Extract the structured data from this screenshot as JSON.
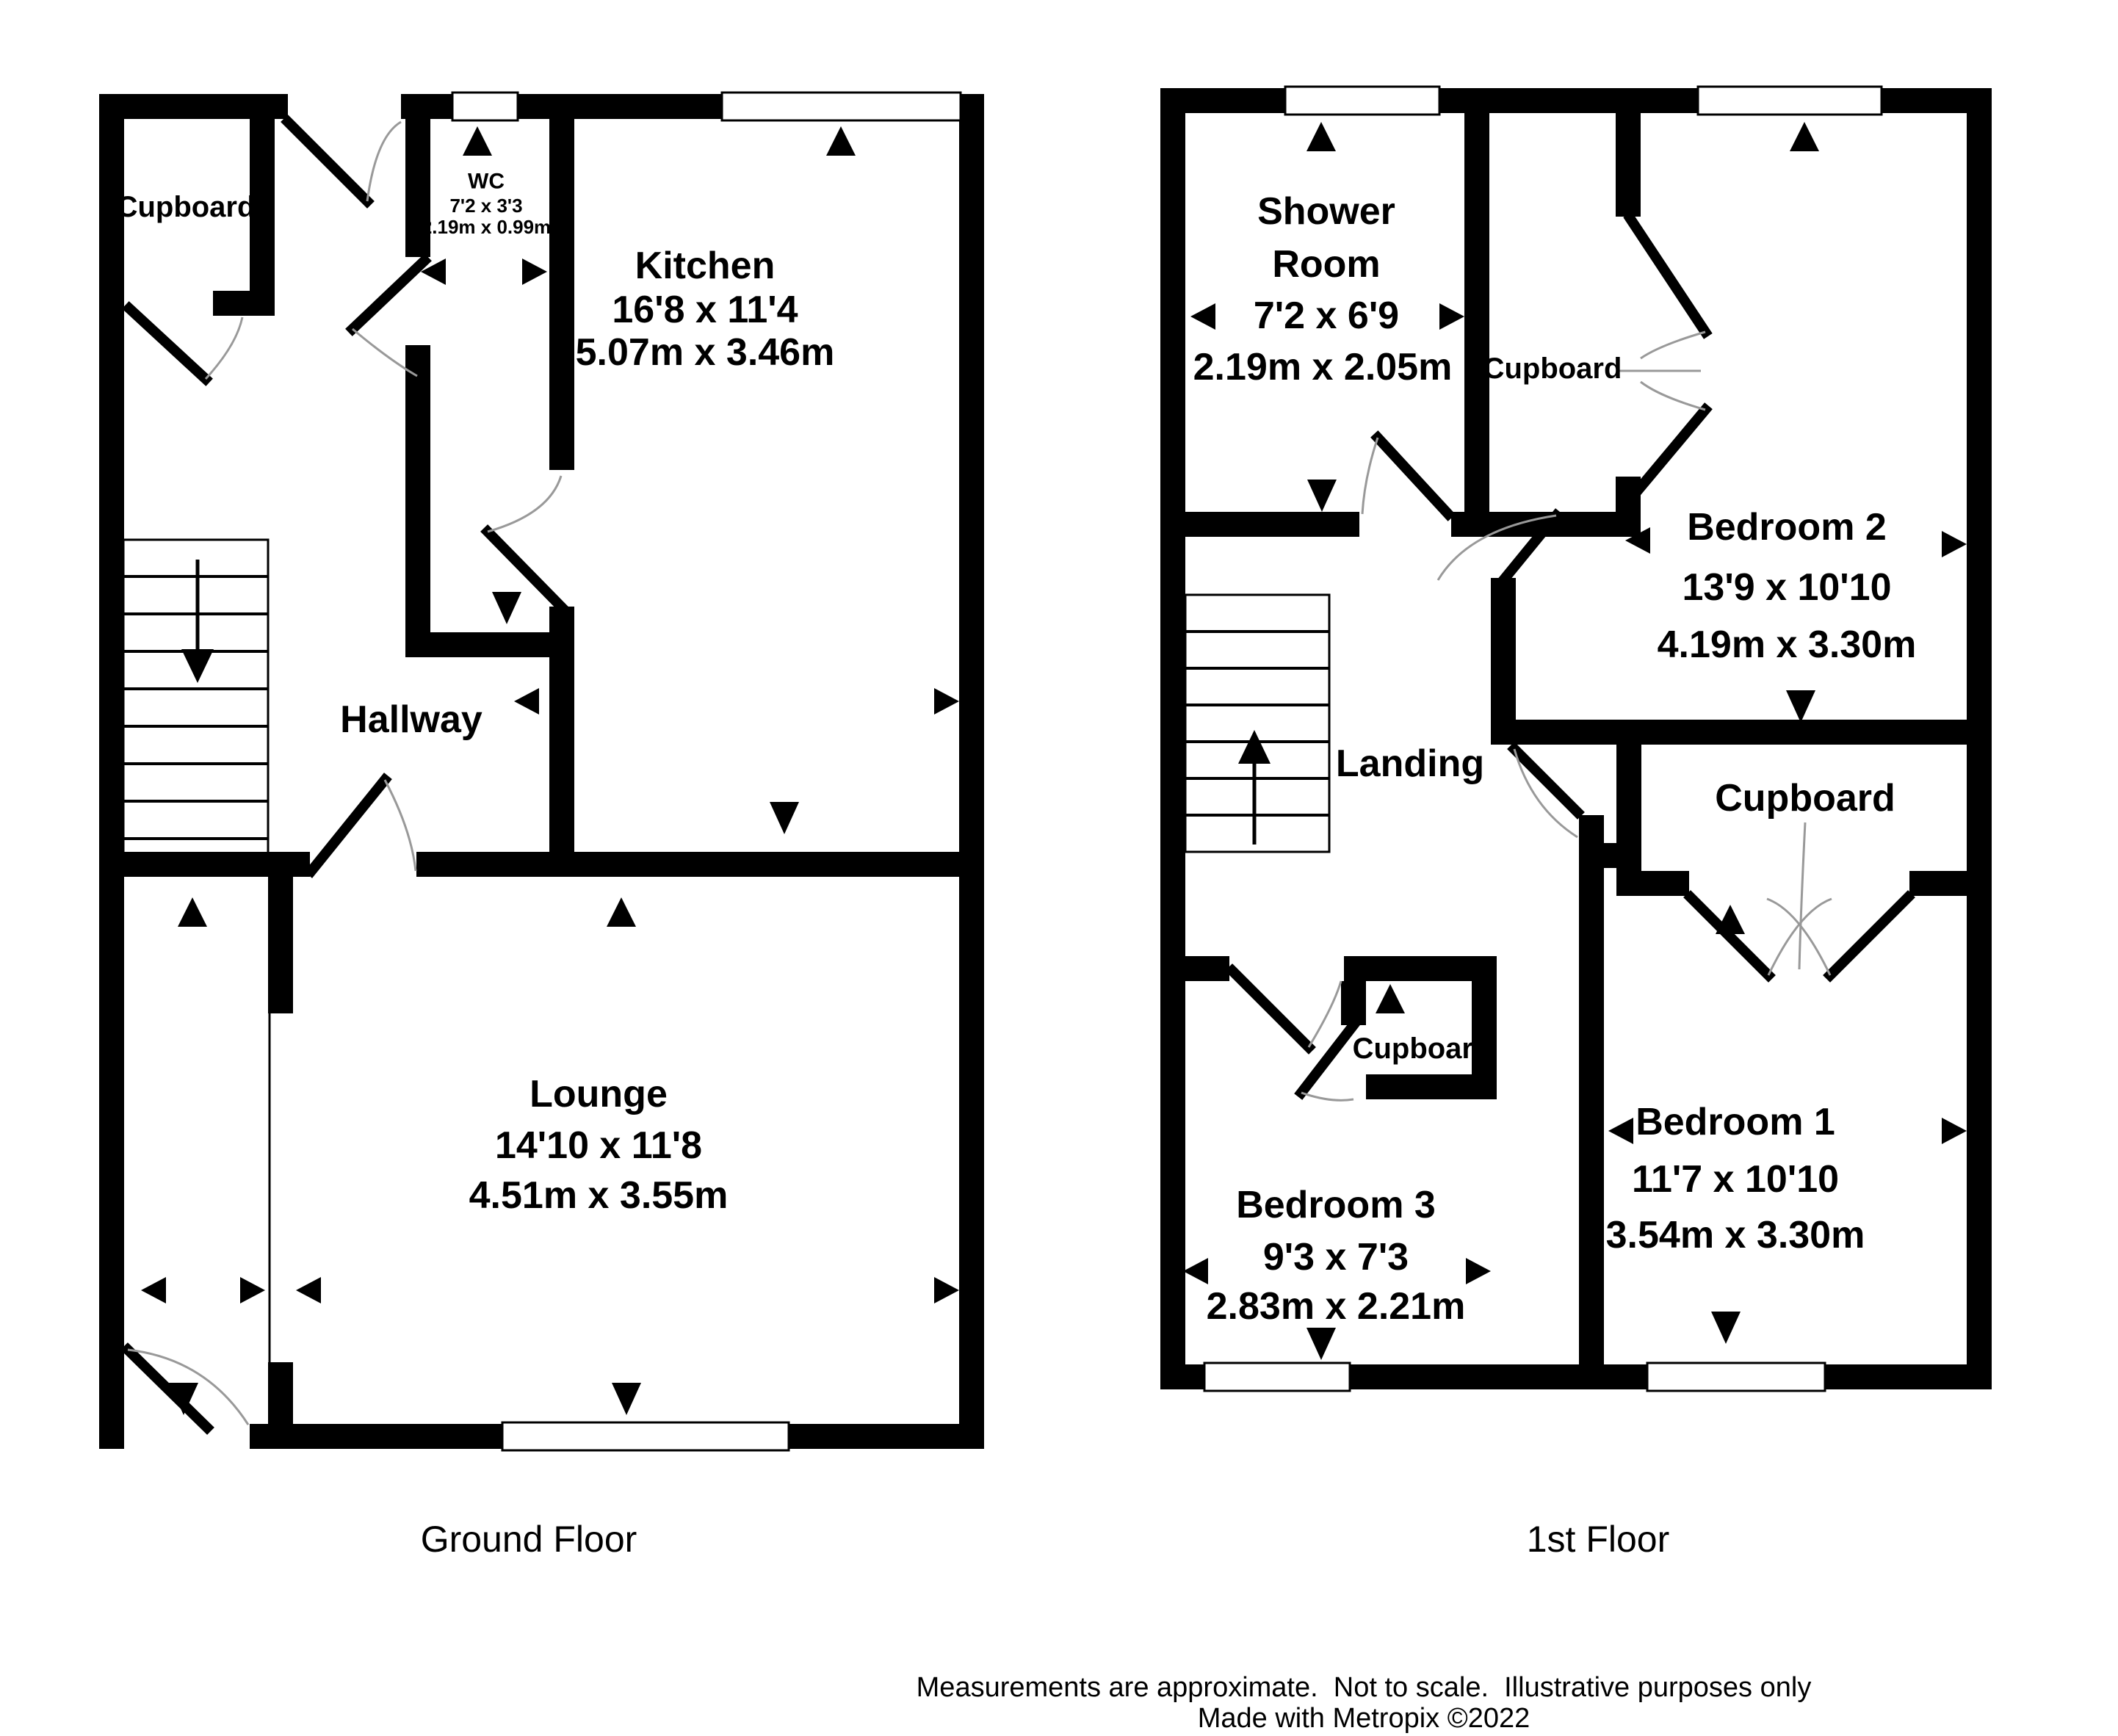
{
  "colors": {
    "wall": "#000000",
    "background": "#ffffff",
    "door_arc": "#999999"
  },
  "ground_floor": {
    "caption": "Ground Floor",
    "rooms": {
      "cupboard": {
        "label": "Cupboard"
      },
      "wc": {
        "label": "WC",
        "imperial": "7'2 x 3'3",
        "metric": "2.19m x 0.99m"
      },
      "kitchen": {
        "label": "Kitchen",
        "imperial": "16'8 x 11'4",
        "metric": "5.07m x 3.46m"
      },
      "hallway": {
        "label": "Hallway"
      },
      "lounge": {
        "label": "Lounge",
        "imperial": "14'10 x 11'8",
        "metric": "4.51m x 3.55m"
      }
    }
  },
  "first_floor": {
    "caption": "1st Floor",
    "rooms": {
      "shower_room": {
        "label_line1": "Shower",
        "label_line2": "Room",
        "imperial": "7'2 x 6'9",
        "metric": "2.19m x 2.05m"
      },
      "cupboard_top": {
        "label": "Cupboard"
      },
      "bedroom2": {
        "label": "Bedroom 2",
        "imperial": "13'9 x 10'10",
        "metric": "4.19m x 3.30m"
      },
      "landing": {
        "label": "Landing"
      },
      "cupboard_right": {
        "label": "Cupboard"
      },
      "cupboard_small": {
        "label": "Cupboard"
      },
      "bedroom3": {
        "label": "Bedroom 3",
        "imperial": "9'3 x 7'3",
        "metric": "2.83m x 2.21m"
      },
      "bedroom1": {
        "label": "Bedroom 1",
        "imperial": "11'7 x 10'10",
        "metric": "3.54m x 3.30m"
      }
    }
  },
  "footer": {
    "line1": "Measurements are approximate.  Not to scale.  Illustrative purposes only",
    "line2": "Made with Metropix ©2022"
  }
}
